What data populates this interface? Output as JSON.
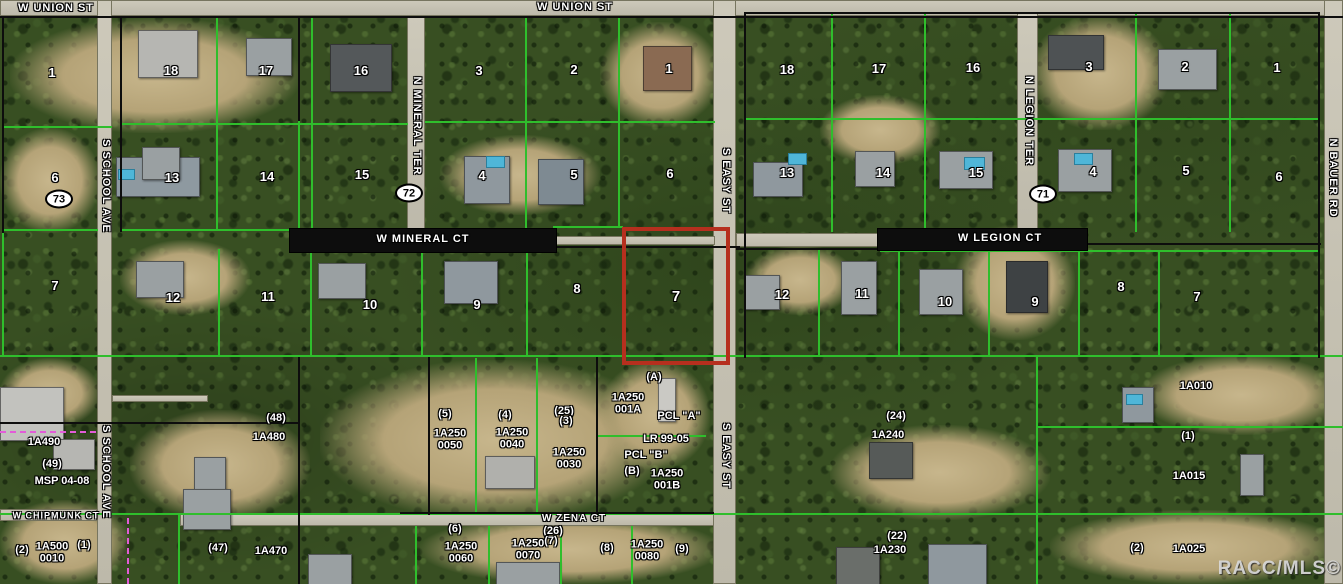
{
  "map": {
    "watermark": "RACC/MLS©",
    "colors": {
      "highlight": "#b62f1e",
      "parcel_line": "#2fbe2c",
      "boundary": "#0d0d0d"
    },
    "street_labels": [
      {
        "text": "W UNION ST",
        "x": 56,
        "y": 9,
        "dir": "h",
        "size": 11
      },
      {
        "text": "W UNION ST",
        "x": 575,
        "y": 8,
        "dir": "h",
        "size": 11
      },
      {
        "text": "S SCHOOL AVE",
        "x": 105,
        "y": 186,
        "dir": "v",
        "size": 11
      },
      {
        "text": "S SCHOOL AVE",
        "x": 105,
        "y": 472,
        "dir": "v",
        "size": 11
      },
      {
        "text": "N MINERAL TER",
        "x": 416,
        "y": 126,
        "dir": "v",
        "size": 11
      },
      {
        "text": "W MINERAL CT",
        "x": 423,
        "y": 240,
        "dir": "h",
        "size": 11
      },
      {
        "text": "S EASY ST",
        "x": 725,
        "y": 181,
        "dir": "v",
        "size": 11
      },
      {
        "text": "S EASY ST",
        "x": 725,
        "y": 456,
        "dir": "v",
        "size": 11
      },
      {
        "text": "N LEGION TER",
        "x": 1028,
        "y": 121,
        "dir": "v",
        "size": 11
      },
      {
        "text": "W LEGION CT",
        "x": 1000,
        "y": 239,
        "dir": "h",
        "size": 11
      },
      {
        "text": "N BAUER RD",
        "x": 1332,
        "y": 178,
        "dir": "v",
        "size": 11
      },
      {
        "text": "W CHIPMUNK CT",
        "x": 56,
        "y": 516,
        "dir": "h",
        "size": 9
      },
      {
        "text": "W ZENA CT",
        "x": 574,
        "y": 519,
        "dir": "h",
        "size": 10
      }
    ],
    "lot_numbers": [
      {
        "text": "1",
        "x": 52,
        "y": 73
      },
      {
        "text": "6",
        "x": 55,
        "y": 178
      },
      {
        "text": "7",
        "x": 55,
        "y": 286
      },
      {
        "text": "18",
        "x": 171,
        "y": 71
      },
      {
        "text": "17",
        "x": 266,
        "y": 71
      },
      {
        "text": "16",
        "x": 361,
        "y": 71
      },
      {
        "text": "13",
        "x": 172,
        "y": 178
      },
      {
        "text": "14",
        "x": 267,
        "y": 177
      },
      {
        "text": "15",
        "x": 362,
        "y": 175
      },
      {
        "text": "3",
        "x": 479,
        "y": 71
      },
      {
        "text": "2",
        "x": 574,
        "y": 70
      },
      {
        "text": "1",
        "x": 669,
        "y": 69
      },
      {
        "text": "4",
        "x": 482,
        "y": 176
      },
      {
        "text": "5",
        "x": 574,
        "y": 175
      },
      {
        "text": "6",
        "x": 670,
        "y": 174
      },
      {
        "text": "18",
        "x": 787,
        "y": 70
      },
      {
        "text": "17",
        "x": 879,
        "y": 69
      },
      {
        "text": "16",
        "x": 973,
        "y": 68
      },
      {
        "text": "3",
        "x": 1089,
        "y": 67
      },
      {
        "text": "2",
        "x": 1185,
        "y": 67
      },
      {
        "text": "1",
        "x": 1277,
        "y": 68
      },
      {
        "text": "13",
        "x": 787,
        "y": 173
      },
      {
        "text": "14",
        "x": 883,
        "y": 173
      },
      {
        "text": "15",
        "x": 976,
        "y": 173
      },
      {
        "text": "4",
        "x": 1093,
        "y": 172
      },
      {
        "text": "5",
        "x": 1186,
        "y": 171
      },
      {
        "text": "6",
        "x": 1279,
        "y": 177
      },
      {
        "text": "12",
        "x": 173,
        "y": 298
      },
      {
        "text": "11",
        "x": 268,
        "y": 297
      },
      {
        "text": "10",
        "x": 370,
        "y": 305
      },
      {
        "text": "9",
        "x": 477,
        "y": 305
      },
      {
        "text": "8",
        "x": 577,
        "y": 289
      },
      {
        "text": "12",
        "x": 782,
        "y": 295
      },
      {
        "text": "11",
        "x": 862,
        "y": 294
      },
      {
        "text": "10",
        "x": 945,
        "y": 302
      },
      {
        "text": "9",
        "x": 1035,
        "y": 302
      },
      {
        "text": "8",
        "x": 1121,
        "y": 287
      },
      {
        "text": "7",
        "x": 1197,
        "y": 297
      }
    ],
    "section_markers": [
      {
        "text": "73",
        "x": 59,
        "y": 199
      },
      {
        "text": "72",
        "x": 409,
        "y": 193
      },
      {
        "text": "71",
        "x": 1043,
        "y": 194
      }
    ],
    "parcel_labels": [
      {
        "text": "1A490",
        "x": 44,
        "y": 443
      },
      {
        "text": "(49)",
        "x": 52,
        "y": 465
      },
      {
        "text": "MSP 04-08",
        "x": 62,
        "y": 482
      },
      {
        "text": "(2)",
        "x": 22,
        "y": 551
      },
      {
        "text": "1A500\n0010",
        "x": 52,
        "y": 553
      },
      {
        "text": "(1)",
        "x": 84,
        "y": 546
      },
      {
        "text": "(48)",
        "x": 276,
        "y": 419
      },
      {
        "text": "1A480",
        "x": 269,
        "y": 438
      },
      {
        "text": "(47)",
        "x": 218,
        "y": 549
      },
      {
        "text": "1A470",
        "x": 271,
        "y": 552
      },
      {
        "text": "(5)",
        "x": 445,
        "y": 415
      },
      {
        "text": "1A250\n0050",
        "x": 450,
        "y": 440
      },
      {
        "text": "(4)",
        "x": 505,
        "y": 416
      },
      {
        "text": "1A250\n0040",
        "x": 512,
        "y": 439
      },
      {
        "text": "(25)",
        "x": 564,
        "y": 412
      },
      {
        "text": "(3)",
        "x": 566,
        "y": 422
      },
      {
        "text": "1A250\n0030",
        "x": 569,
        "y": 459
      },
      {
        "text": "(A)",
        "x": 654,
        "y": 378
      },
      {
        "text": "1A250\n001A",
        "x": 628,
        "y": 404
      },
      {
        "text": "PCL \"A\"",
        "x": 679,
        "y": 417
      },
      {
        "text": "LR 99-05",
        "x": 666,
        "y": 440
      },
      {
        "text": "PCL \"B\"",
        "x": 646,
        "y": 456
      },
      {
        "text": "(B)",
        "x": 632,
        "y": 472
      },
      {
        "text": "1A250\n001B",
        "x": 667,
        "y": 480
      },
      {
        "text": "(6)",
        "x": 455,
        "y": 530
      },
      {
        "text": "1A250\n0060",
        "x": 461,
        "y": 553
      },
      {
        "text": "(26)",
        "x": 553,
        "y": 532
      },
      {
        "text": "(7)",
        "x": 551,
        "y": 542
      },
      {
        "text": "1A250\n0070",
        "x": 528,
        "y": 550
      },
      {
        "text": "(8)",
        "x": 607,
        "y": 549
      },
      {
        "text": "1A250\n0080",
        "x": 647,
        "y": 551
      },
      {
        "text": "(9)",
        "x": 682,
        "y": 550
      },
      {
        "text": "(24)",
        "x": 896,
        "y": 417
      },
      {
        "text": "1A240",
        "x": 888,
        "y": 436
      },
      {
        "text": "(22)",
        "x": 897,
        "y": 537
      },
      {
        "text": "1A230",
        "x": 890,
        "y": 551
      },
      {
        "text": "1A010",
        "x": 1196,
        "y": 387
      },
      {
        "text": "(1)",
        "x": 1188,
        "y": 437
      },
      {
        "text": "1A015",
        "x": 1189,
        "y": 477
      },
      {
        "text": "(2)",
        "x": 1137,
        "y": 549
      },
      {
        "text": "1A025",
        "x": 1189,
        "y": 550
      }
    ],
    "highlighted_parcel": {
      "label": "7",
      "x": 622,
      "y": 227,
      "width": 100,
      "height": 130
    }
  }
}
